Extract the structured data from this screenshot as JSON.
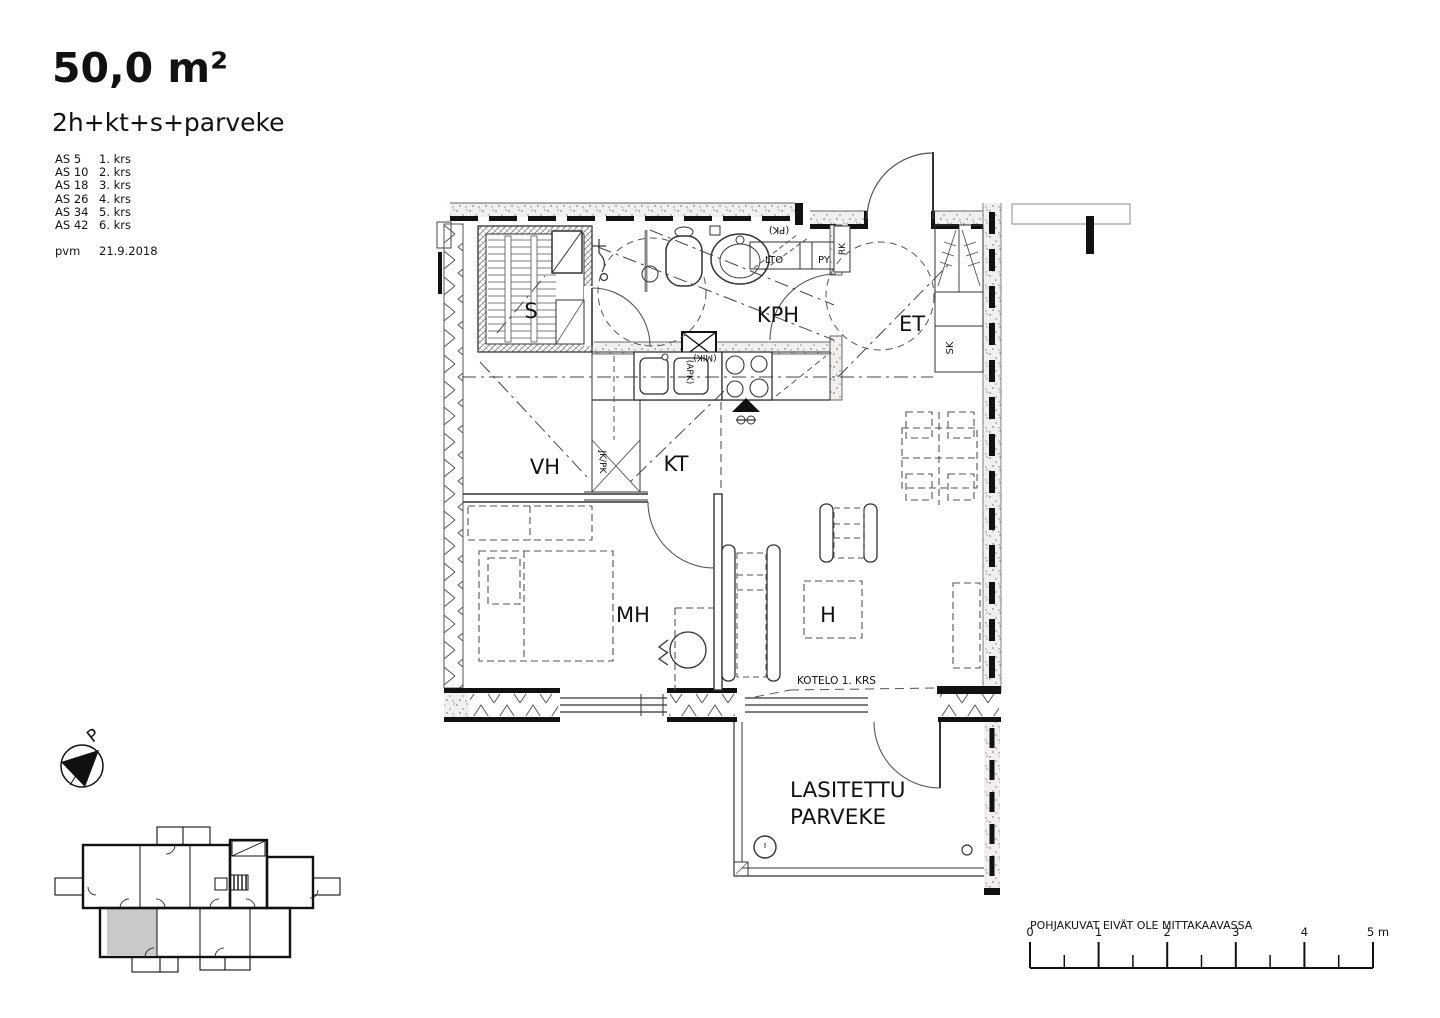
{
  "header": {
    "area": "50,0 m²",
    "layout": "2h+kt+s+parveke",
    "apartments": [
      {
        "as": "AS 5",
        "floor": "1. krs"
      },
      {
        "as": "AS 10",
        "floor": "2. krs"
      },
      {
        "as": "AS 18",
        "floor": "3. krs"
      },
      {
        "as": "AS 26",
        "floor": "4. krs"
      },
      {
        "as": "AS 34",
        "floor": "5. krs"
      },
      {
        "as": "AS 42",
        "floor": "6. krs"
      }
    ],
    "date_label": "pvm",
    "date": "21.9.2018"
  },
  "plan": {
    "rooms": {
      "sauna": "S",
      "bathroom": "KPH",
      "entry": "ET",
      "walkin": "VH",
      "kitchen": "KT",
      "bedroom": "MH",
      "living": "H",
      "balcony_line1": "LASITETTU",
      "balcony_line2": "PARVEKE"
    },
    "small_labels": {
      "lto": "LTO",
      "py": "PY",
      "pk": "(PK)",
      "rk": "RK",
      "sk": "SK",
      "mik": "(MIK)",
      "apk": "(APK)",
      "jkpk": "JK/PK",
      "kotelo": "KOTELO 1. KRS"
    }
  },
  "compass": {
    "north_letter": "P"
  },
  "footer": {
    "disclaimer": "POHJAKUVAT EIVÄT OLE MITTAKAAVASSA",
    "scale_ticks": [
      "0",
      "1",
      "2",
      "3",
      "4",
      "5 m"
    ]
  },
  "colors": {
    "ink": "#111111",
    "wall_dot": "#8a8a8a",
    "dash_line": "#555555",
    "highlight_unit": "#c9c9c9"
  }
}
